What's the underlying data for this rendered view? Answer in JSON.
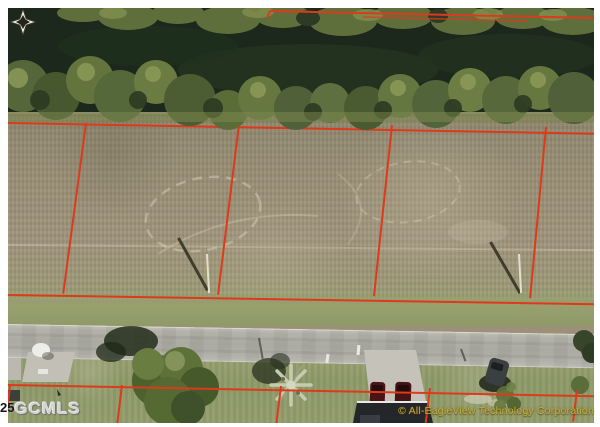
{
  "watermarks": {
    "mls_partial": "25",
    "mls": "GCMLS",
    "copyright": "© All-EagleView Technology Corporation"
  },
  "icons": {
    "compass": "compass-rose"
  },
  "colors": {
    "frame": "#ffffff",
    "lot_line": "#dd3a1c",
    "water": "#1b281b",
    "canopy_dark": "#4c5d33",
    "canopy_light": "#6d7e45",
    "field_dirt": "#9c9178",
    "grass": "#8f9a69",
    "road": "#a8a8a0",
    "house_roof": "#24272a",
    "vehicle_maroon": "#4a1316",
    "vehicle_dark": "#3a3f41",
    "mls_text": "#d2d2d2",
    "mls_prefix_text": "#14141f",
    "copyright_text": "#b2b73d"
  }
}
